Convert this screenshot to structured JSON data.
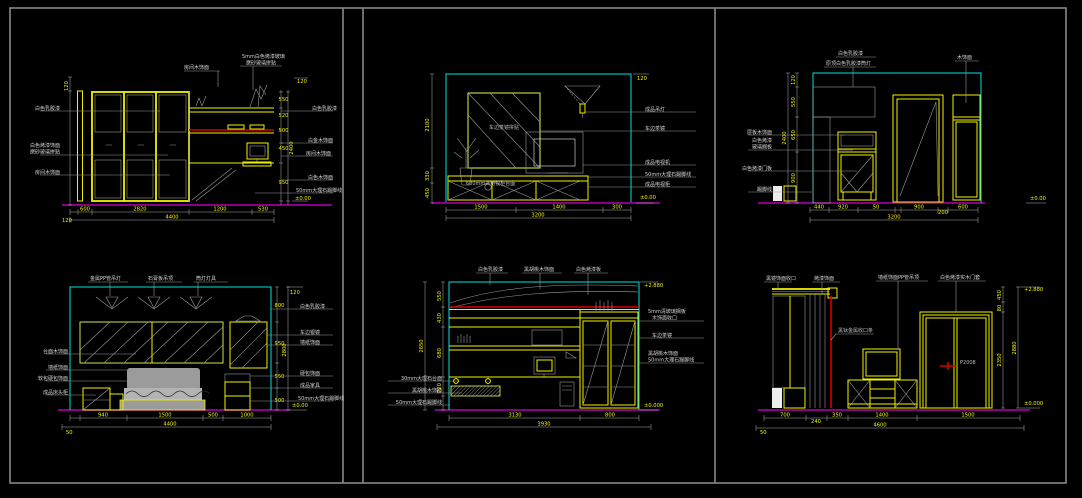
{
  "window": {
    "description": "CAD furniture elevation design sheet, six interior elevation drawings on black model space"
  },
  "colors": {
    "background": "#000000",
    "frame_gray": "#8f8f8f",
    "line_yellow": "#f2f200",
    "line_cyan": "#00e0e0",
    "floor_magenta": "#b400b4",
    "accent_red": "#d80000",
    "hatch_gray": "#9a9a9a",
    "label_text": "#d4d4d4"
  },
  "d1": {
    "top_label_1": "房间木饰面",
    "top_label_2a": "5mm白色烤漆玻璃",
    "top_label_2b": "磨砂玻璃拼贴",
    "left_labels": [
      "白色乳胶漆",
      "白色烤漆饰面",
      "磨砂玻璃拼贴",
      "房间木饰面"
    ],
    "right_labels": [
      "白色乳胶漆",
      "白金木饰面",
      "房间木饰面",
      "白色木饰面",
      "50mm大理石踢脚线"
    ],
    "right_vdims": [
      "550",
      "520",
      "500",
      "450",
      "950"
    ],
    "right_vtotal": "2400",
    "ceil_tick": "120",
    "left_vdim": "120",
    "level": "±0.00",
    "dims": [
      "600",
      "2820",
      "1200",
      "530"
    ],
    "total": "4400",
    "total_left": "120"
  },
  "d2": {
    "panel_label": "车边茶镜拼贴",
    "cabinet_label": "600mm高电视柜台面",
    "right_labels": [
      "成品吊灯",
      "车边茶镜",
      "成品电视机",
      "50mm大理石踢脚线",
      "成品电视柜"
    ],
    "ceil_tick": "120",
    "left_vdims": [
      "2100",
      "330",
      "450"
    ],
    "level": "±0.00",
    "dims": [
      "1500",
      "1400",
      "300"
    ],
    "total": "3200"
  },
  "d3": {
    "top_label_1": "白色乳胶漆",
    "top_label_2": "原顶白色乳胶漆筒灯",
    "right_label": "木饰面",
    "left_labels": [
      "层板木饰面",
      "白色烤漆",
      "玻璃搁板",
      "白色烤漆门板",
      "踢脚线"
    ],
    "left_vdims": [
      "120",
      "550",
      "650",
      "900"
    ],
    "left_vtotal": "2400",
    "level": "±0.00",
    "dims": [
      "440",
      "920",
      "50",
      "900",
      "200",
      "600"
    ],
    "total": "3200"
  },
  "d4": {
    "top_labels": [
      "金属PP管吊灯",
      "石膏板吊顶",
      "筒灯灯具"
    ],
    "left_labels": [
      "台面木饰面",
      "墙纸饰面",
      "软包硬包饰面",
      "成品床头柜"
    ],
    "right_labels": [
      "白色乳胶漆",
      "车边银镜",
      "墙纸饰面",
      "硬包饰面",
      "成品家具",
      "50mm大理石踢脚线"
    ],
    "right_vdims": [
      "800",
      "950",
      "550",
      "500"
    ],
    "right_vtotal": "2800",
    "ceil_tick": "120",
    "level": "±0.00",
    "dims": [
      "940",
      "1500",
      "500",
      "1000"
    ],
    "total": "4400",
    "total_left": "50"
  },
  "d5": {
    "top_labels": [
      "白色乳胶漆",
      "黑胡桃木饰面",
      "白色烤漆板"
    ],
    "right_labels_1": [
      "5mm清玻璃搁板",
      "木饰面收口"
    ],
    "right_label_2": "车边茶镜",
    "right_labels_3": [
      "黑胡桃木饰面",
      "50mm大理石踢脚线"
    ],
    "left_labels": [
      "30mm大理石台面",
      "黑胡桃木饰面",
      "50mm大理石踢脚线"
    ],
    "left_vdims": [
      "550",
      "430",
      "680",
      "720"
    ],
    "left_vtotal": "2650",
    "ceil_level": "+2.880",
    "level": "±0.000",
    "dims": [
      "3130",
      "800"
    ],
    "total": "3930"
  },
  "d6": {
    "top_labels": [
      "黑镜饰面收口",
      "烤漆饰面",
      "墙纸饰面PP管吊顶",
      "白色烤漆实木门套"
    ],
    "mid_label": "黑钛金属收口条",
    "door_label": "P2008",
    "right_vdims": [
      "450",
      "80",
      "2350"
    ],
    "right_vtotal": "2880",
    "ceil_level": "+2.880",
    "level": "±0.000",
    "dims": [
      "700",
      "240",
      "350",
      "1400",
      "1500"
    ],
    "total": "4600",
    "total_left": "50"
  }
}
